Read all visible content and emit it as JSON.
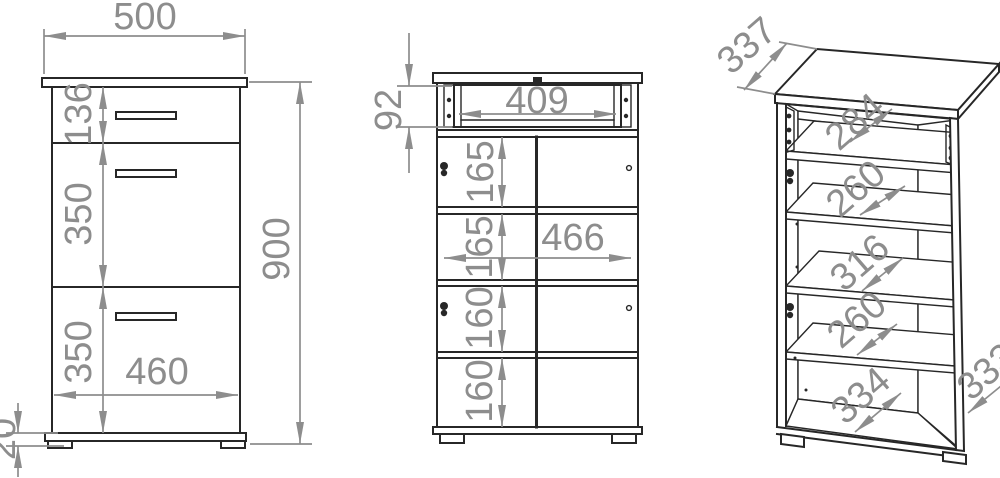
{
  "drawing": {
    "front_view": {
      "width": "500",
      "drawer_height": "136",
      "middle_section_height": "350",
      "bottom_section_height": "350",
      "inner_width": "460",
      "total_height": "900",
      "plinth_height": "20"
    },
    "section_view": {
      "drawer_box_height": "92",
      "drawer_inner_width": "409",
      "compartment1_height": "165",
      "compartment2_height": "165",
      "inner_width": "466",
      "compartment3_height": "160",
      "compartment4_height": "160"
    },
    "perspective_view": {
      "top_depth": "337",
      "drawer_depth": "284",
      "upper_shelf_depth": "260",
      "middle_shelf_depth": "316",
      "lower_shelf_depth": "260",
      "bottom_depth": "334",
      "side_depth": "333"
    },
    "colors": {
      "outline": "#272727",
      "dimension": "#8d8d8d",
      "background": "#ffffff"
    }
  }
}
